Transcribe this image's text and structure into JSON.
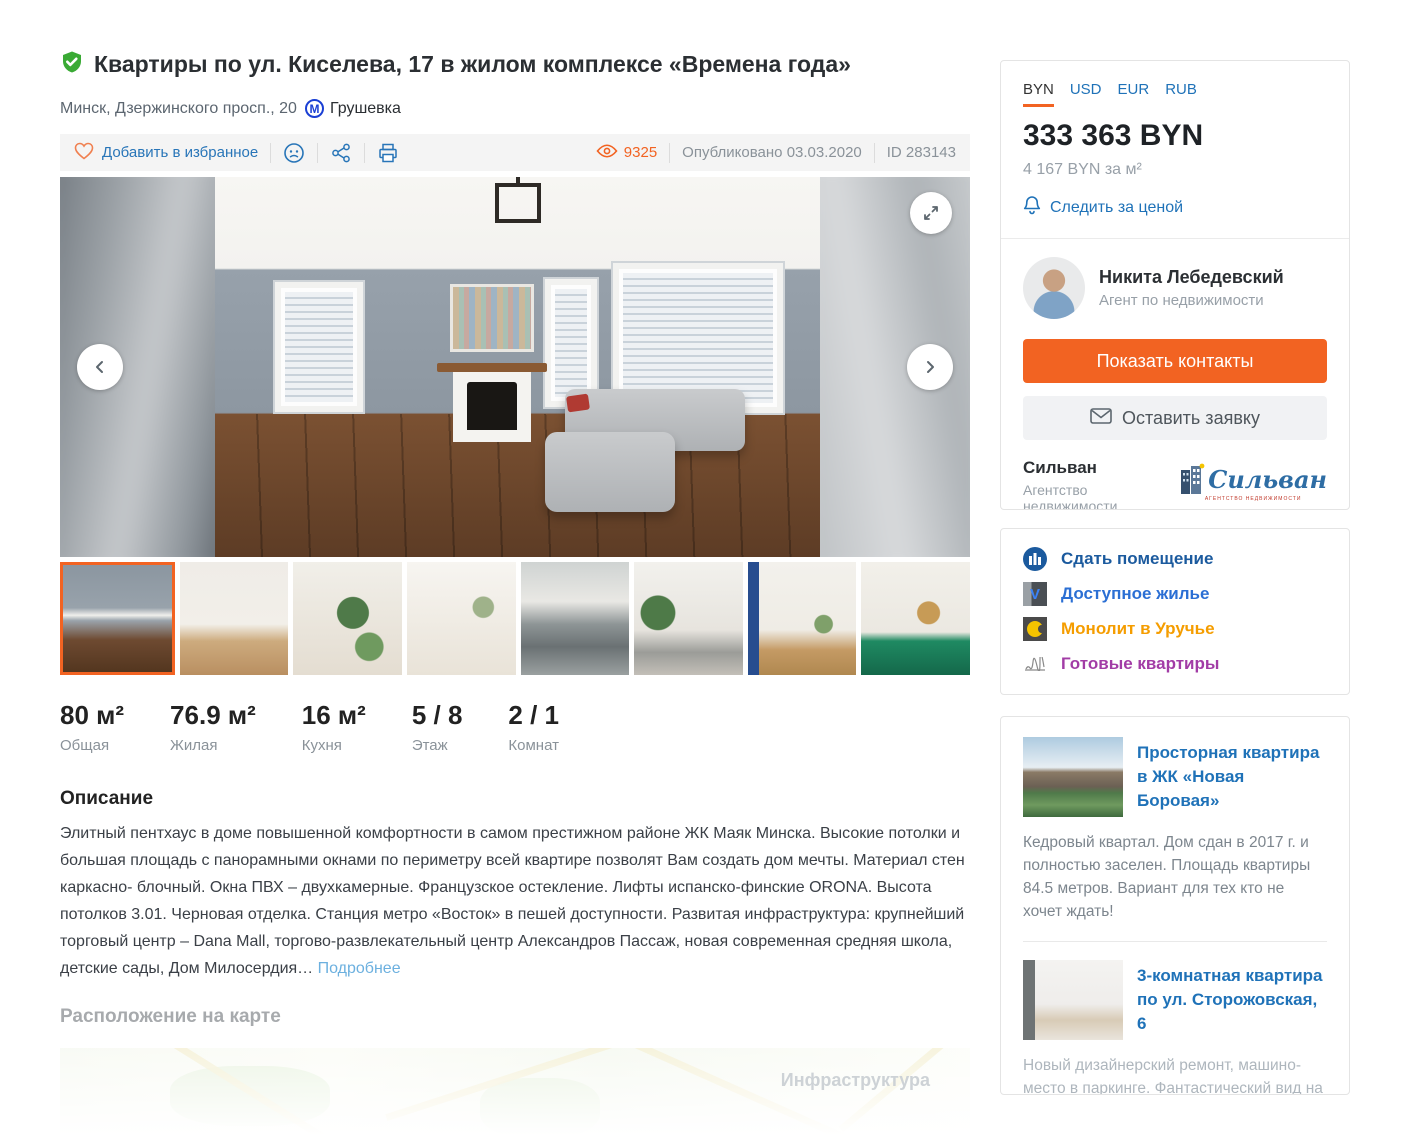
{
  "header": {
    "title": "Квартиры по ул. Киселева, 17 в жилом комплексе «Времена года»",
    "address": "Минск, Дзержинского просп., 20",
    "metro_letter": "М",
    "metro": "Грушевка"
  },
  "toolbar": {
    "favorite_label": "Добавить в избранное",
    "views_count": "9325",
    "published_label": "Опубликовано 03.03.2020",
    "id_label": "ID 283143"
  },
  "stats": [
    {
      "value": "80 м²",
      "label": "Общая"
    },
    {
      "value": "76.9 м²",
      "label": "Жилая"
    },
    {
      "value": "16 м²",
      "label": "Кухня"
    },
    {
      "value": "5 / 8",
      "label": "Этаж"
    },
    {
      "value": "2 / 1",
      "label": "Комнат"
    }
  ],
  "description": {
    "heading": "Описание",
    "text": "Элитный пентхаус в доме повышенной комфортности в самом престижном районе ЖК Маяк Минска. Высокие потолки и большая площадь с панорамными окнами по периметру всей квартире позволят Вам создать дом мечты. Материал стен каркасно- блочный. Окна ПВХ – двухкамерные. Французское остекление. Лифты испанско-финские ORONA. Высота потолков 3.01. Черновая отделка. Станция метро «Восток» в пешей доступности. Развитая инфраструктура: крупнейший торговый центр – Dana Mall, торгово-развлекательный центр Александров Пассаж, новая современная средняя школа, детские сады, Дом Милосердия… ",
    "more_label": "Подробнее"
  },
  "map_section": {
    "heading": "Расположение на карте",
    "overlay_label": "Инфраструктура"
  },
  "sidebar": {
    "currencies": {
      "tabs": [
        "BYN",
        "USD",
        "EUR",
        "RUB"
      ],
      "active": "BYN"
    },
    "price": "333 363 BYN",
    "price_per_m2": "4 167 BYN за м²",
    "watch_price_label": "Следить за ценой",
    "agent": {
      "name": "Никита Лебедевский",
      "role": "Агент по недвижимости"
    },
    "contacts_button": "Показать контакты",
    "request_button": "Оставить заявку",
    "agency": {
      "name": "Сильван",
      "type": "Агентство недвижимости",
      "listings_link": "165 объявлений",
      "logo_text": "Сильван",
      "logo_caption": "агентство недвижимости"
    },
    "quick_links": [
      {
        "label": "Сдать помещение",
        "color": "#1b5a9e"
      },
      {
        "label": "Доступное жилье",
        "color": "#2b6fd4"
      },
      {
        "label": "Монолит в Уручье",
        "color": "#f59d00"
      },
      {
        "label": "Готовые квартиры",
        "color": "#a23ca6"
      }
    ],
    "related": [
      {
        "title": "Просторная квартира в ЖК «Новая Боровая»",
        "text": "Кедровый квартал. Дом сдан в 2017 г. и полностью заселен. Площадь квартиры 84.5 метров. Вариант для тех кто не хочет ждать!"
      },
      {
        "title": "3-комнатная квартира по ул. Сторожовская, 6",
        "text": "Новый дизайнерский ремонт, машино-место в паркинге. Фантастический вид на набережную реки Свислочь. Ключи в день сделки!"
      }
    ]
  },
  "colors": {
    "accent_orange": "#f26322",
    "link_blue": "#1f72b8"
  }
}
